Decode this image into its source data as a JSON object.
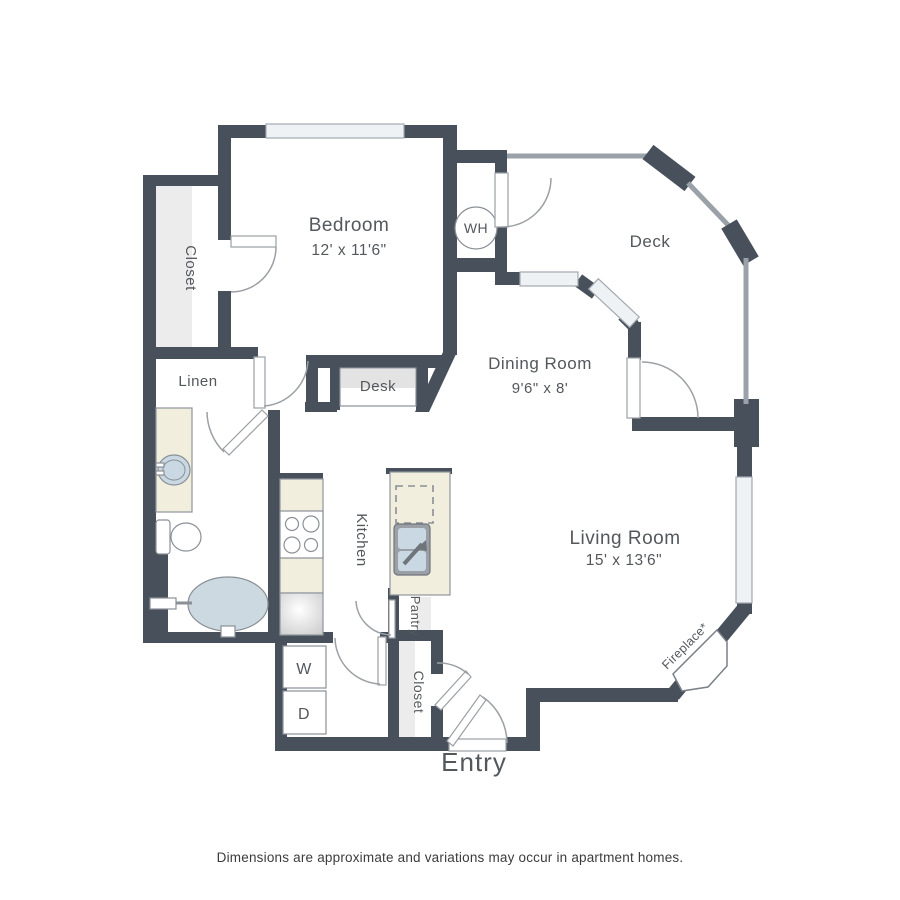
{
  "plan": {
    "title_hidden": "",
    "rooms": {
      "bedroom": {
        "name": "Bedroom",
        "dims": "12' x 11'6\""
      },
      "dining": {
        "name": "Dining Room",
        "dims": "9'6\" x 8'"
      },
      "living": {
        "name": "Living Room",
        "dims": "15' x 13'6\""
      },
      "deck": {
        "name": "Deck"
      },
      "kitchen": {
        "name": "Kitchen"
      },
      "pantry": {
        "name": "Pantry"
      },
      "bedroom_closet": {
        "name": "Closet"
      },
      "entry_closet": {
        "name": "Closet"
      },
      "linen": {
        "name": "Linen"
      },
      "entry": {
        "name": "Entry"
      }
    },
    "fixtures": {
      "water_heater": "WH",
      "washer": "W",
      "dryer": "D",
      "desk": "Desk",
      "fireplace": "Fireplace*"
    },
    "footer": "Dimensions are approximate and variations may occur in apartment homes.",
    "colors": {
      "wall": "#47505b",
      "railing": "#9ba1a8",
      "window_fill": "#eef2f4",
      "counter_cream": "#f1eedd",
      "fixture_blue": "#c9d8e2",
      "room_shading": "#ececec",
      "label_text": "#54585c"
    }
  }
}
